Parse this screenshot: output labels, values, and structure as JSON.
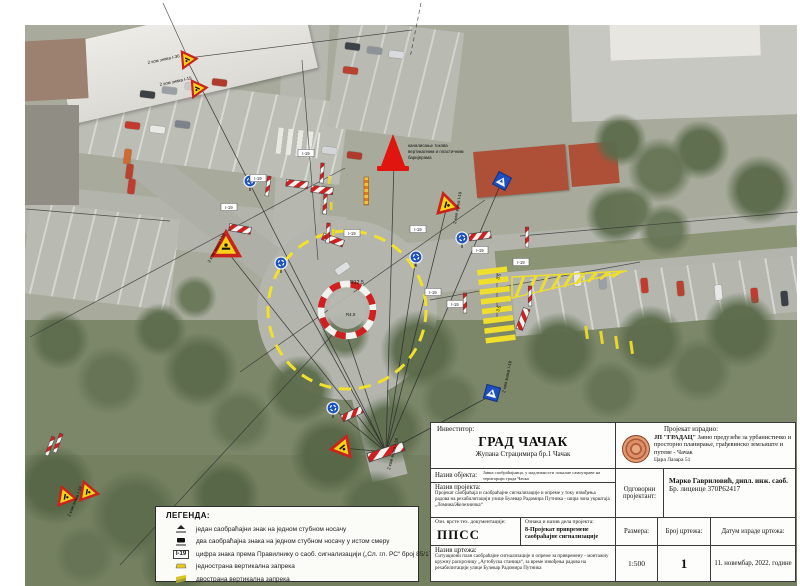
{
  "map": {
    "code_box": "I-19",
    "cone_note_1": "каналисање токова",
    "cone_note_2": "вертикалним и пластичним",
    "cone_note_3": "баријерама",
    "qty_i30": "2 ком знака I-30",
    "qty_i19": "2 ком знака I-19",
    "dim_outer": "R12.5",
    "dim_inner": "R4.0",
    "dim_lane": "3.5"
  },
  "legend": {
    "title": "ЛЕГЕНДА:",
    "code": "I-19",
    "items": [
      {
        "label": "један саобраћајни знак на једном стубном носачу"
      },
      {
        "label": "два саобраћајна знака на једном стубном носачу у истом смеру"
      },
      {
        "label": "цифра знака према Правилнику о саоб. сигнализацији („Сл. гл. РС“ број 85/17 и 14/21)"
      },
      {
        "label": "једнострана вертикална запрека"
      },
      {
        "label": "двострана вертикална запрека"
      }
    ]
  },
  "tb": {
    "investor_label": "Инвеститор:",
    "investor_name": "ГРАД ЧАЧАК",
    "investor_address": "Жупана Страцимира бр.1 Чачак",
    "made_by_label": "Пројекат израдио:",
    "company_name": "ЈП \"ГРАДАЦ\"",
    "company_desc": "Јавно предузеће за урбанистичко и просторно планирање, грађевинско земљиште и путеве - Чачак",
    "company_address": "Цара Лазара 51",
    "object_label": "Назив објекта:",
    "object_text": "Јавна саобраћајница, у надлежности локалне самоуправе на територији града Чачка",
    "project_label": "Назив пројекта:",
    "project_text": "Пројекат саобраћаја и саобраћајне сигнализације и опреме у току извођења радова на рехабилитацији улице Булевар Радомира Путника - шира зона укрштаја „Ломина/Железничка“",
    "designer_label": "Одговорни пројектант:",
    "designer_name": "Марко Гавриловић, дипл. инж. саоб.",
    "designer_license": "Бр. лиценце 370Р62417",
    "doc_type_label": "Озн. врсте тех. документације:",
    "doc_type_value": "ППСС",
    "part_label": "Ознака и назив дела пројекта:",
    "part_value": "8-Пројекат привремене саобраћајне сигнализације",
    "scale_label": "Размера:",
    "scale_value": "1:500",
    "number_label": "Број цртежа:",
    "number_value": "1",
    "date_label": "Датум израде цртежа:",
    "date_value": "11. новембар, 2022. године",
    "drawing_label": "Назив цртежа:",
    "drawing_text": "Ситуациони план саобраћајне сигнализације и опреме за привремену - монтажну кружну раскрсницу „Аутобуска станица“, за време извођења радова на рехабилитацији улице Булевар Радомира Путника"
  }
}
